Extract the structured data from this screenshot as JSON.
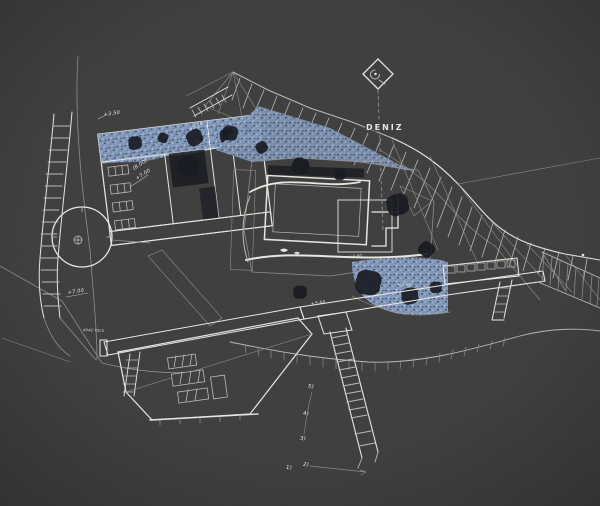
{
  "title": "Hand-drawn architectural site plan sketch (white ink on dark ground, water areas in blue)",
  "palette": {
    "background": "#3b3b3b",
    "ink": "#e6e6e1",
    "ink_dim": "#b9b9b3",
    "ink_faint": "#8b8b86",
    "blue_base": "#8096b8",
    "blue_light": "#b6c6de",
    "blue_dark": "#3a4763",
    "pool_base": "#414c5c",
    "pool_dark": "#262f3c",
    "pool_light": "#627082",
    "shadow": "#14161d"
  },
  "labels": {
    "deniz": "DENIZ",
    "road": "ARAÇ YOLU"
  },
  "annotations": [
    {
      "name": "elevation-8-00",
      "text": "(8.00)"
    },
    {
      "name": "elevation-7-00-a",
      "text": "+7.00"
    },
    {
      "name": "elevation-7-00-b",
      "text": "+7.00"
    },
    {
      "name": "elevation-3-50",
      "text": "+3.50"
    },
    {
      "name": "elevation-5-74",
      "text": "+5.74"
    },
    {
      "name": "elevation-5-60",
      "text": "+5.60"
    },
    {
      "name": "elevation-5-00",
      "text": "+5.00"
    },
    {
      "name": "elevation-2-60",
      "text": "+2.60"
    }
  ],
  "step_markers": [
    {
      "text": "5)"
    },
    {
      "text": "4)"
    },
    {
      "text": "3)"
    },
    {
      "text": "2)"
    },
    {
      "text": "1)"
    }
  ]
}
